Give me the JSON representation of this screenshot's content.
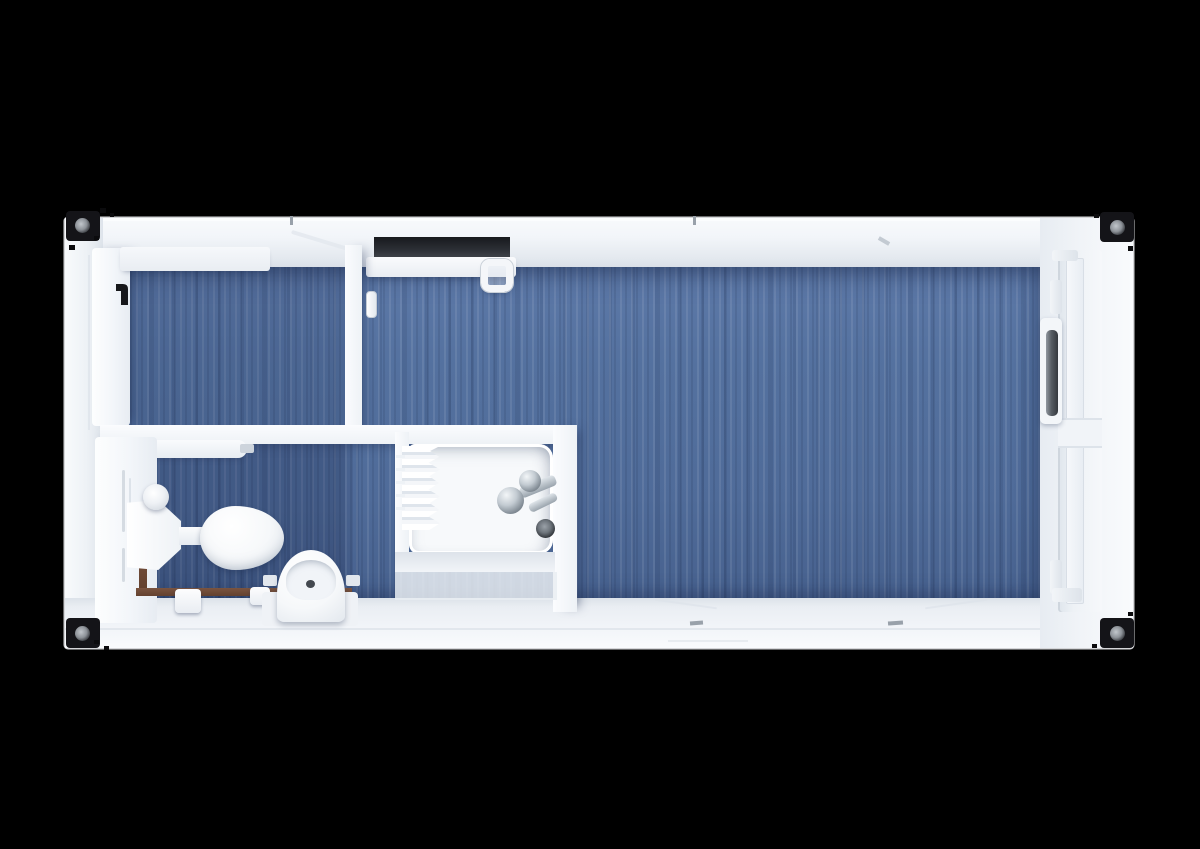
{
  "scene": {
    "type": "top-down 3d floor plan render",
    "subject": "portable container cabin with entry room, bathroom and large main room",
    "background_color": "#000000",
    "visible_text": "none"
  },
  "palette": {
    "wall_white": "#f2f5f9",
    "floor_blue": "#54719f",
    "floor_blue_dark": "#47618e",
    "casting_black": "#141418",
    "pipe_brown": "#6b4632",
    "chrome": "#aab3bc",
    "handle_gray": "#3c4148",
    "window_void": "#24272d"
  },
  "labels": {
    "shell": "container shell",
    "entry_room": "entry room",
    "main_room": "main room",
    "bathroom": "bathroom",
    "shower": "shower cabin",
    "shower_tray": "shower tray",
    "shower_curtain": "shower curtain",
    "shower_mixer": "shower mixer tap",
    "shower_drain": "floor drain",
    "toilet_cistern": "toilet cistern",
    "toilet_bowl": "toilet bowl",
    "flush_button": "flush button",
    "washbasin": "washbasin",
    "basin_tap": "basin tap",
    "water_pipe": "water pipe",
    "entry_door": "entry door",
    "entry_door_handle": "entry door handle",
    "interior_door": "interior door leaf",
    "interior_door_handle": "interior door handle",
    "top_window": "open top-wall window",
    "top_window_handle": "window latch handle",
    "end_door": "glazed end door",
    "end_door_handle": "end door handle",
    "corner_castings": [
      "top-left",
      "top-right",
      "bottom-left",
      "bottom-right"
    ]
  }
}
